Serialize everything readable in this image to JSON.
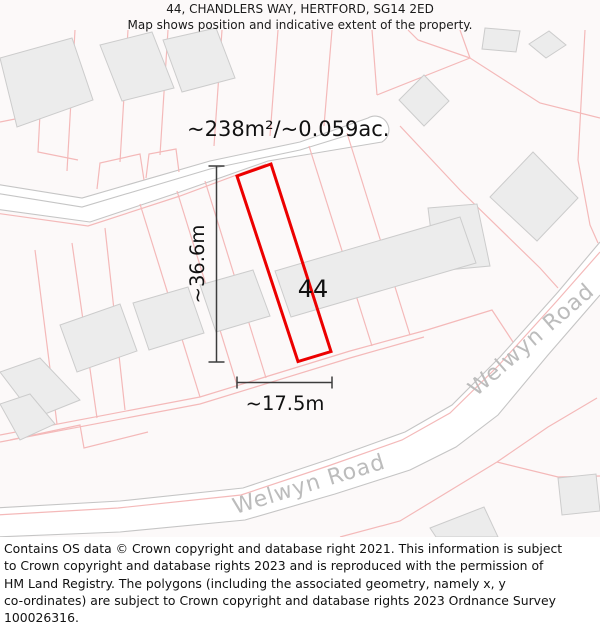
{
  "header": {
    "title": "44, CHANDLERS WAY, HERTFORD, SG14 2ED",
    "subtitle": "Map shows position and indicative extent of the property."
  },
  "map": {
    "area_label": "~238m²/~0.059ac.",
    "plot_number": "44",
    "height_dimension": "~36.6m",
    "width_dimension": "~17.5m",
    "road_labels": [
      "Welwyn Road",
      "Welwyn Road"
    ],
    "colors": {
      "plot_outline": "#ec0000",
      "parcel_line": "#f4b9b9",
      "road_edge": "#c5c5c5",
      "building_fill": "#ececec",
      "building_stroke": "#cccccc",
      "road_text": "#bcbcbc",
      "dimension_line": "#3c3c3c"
    }
  },
  "footer": {
    "lines": [
      "Contains OS data © Crown copyright and database right 2021. This information is subject",
      "to Crown copyright and database rights 2023 and is reproduced with the permission of",
      "HM Land Registry. The polygons (including the associated geometry, namely x, y",
      "co-ordinates) are subject to Crown copyright and database rights 2023 Ordnance Survey",
      "100026316."
    ]
  }
}
